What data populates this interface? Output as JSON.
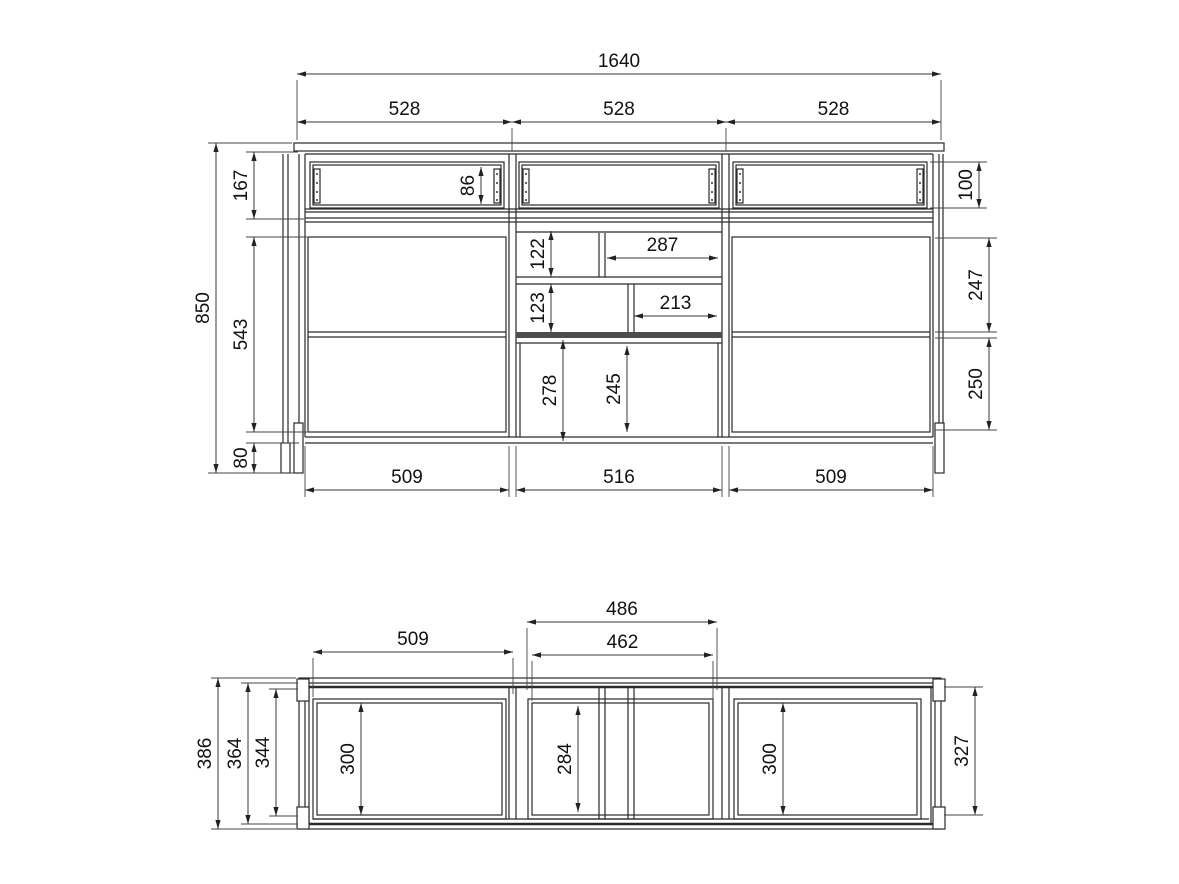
{
  "drawing": {
    "title": "furniture-sideboard-dimension-drawing",
    "units": "mm",
    "line_color": "#2a2a2a",
    "dim_color": "#222222",
    "background": "#ffffff",
    "views": {
      "front": {
        "name": "front-elevation",
        "overall_width": "1640",
        "overall_height": "850",
        "dimensions": [
          {
            "value": "1640",
            "orient": "h",
            "from": 297,
            "to": 941,
            "at": 74
          },
          {
            "value": "528",
            "orient": "h",
            "from": 297,
            "to": 512,
            "at": 122
          },
          {
            "value": "528",
            "orient": "h",
            "from": 512,
            "to": 726,
            "at": 122
          },
          {
            "value": "528",
            "orient": "h",
            "from": 726,
            "to": 941,
            "at": 122
          },
          {
            "value": "850",
            "orient": "v",
            "from": 143,
            "to": 473,
            "at": 216
          },
          {
            "value": "167",
            "orient": "v",
            "from": 152,
            "to": 219,
            "at": 254
          },
          {
            "value": "543",
            "orient": "v",
            "from": 237,
            "to": 432,
            "at": 254
          },
          {
            "value": "80",
            "orient": "v",
            "from": 443,
            "to": 473,
            "at": 254
          },
          {
            "value": "86",
            "orient": "v",
            "from": 167,
            "to": 204,
            "at": 481
          },
          {
            "value": "100",
            "orient": "v",
            "from": 162,
            "to": 208,
            "at": 979
          },
          {
            "value": "247",
            "orient": "v",
            "from": 238,
            "to": 332,
            "at": 989
          },
          {
            "value": "250",
            "orient": "v",
            "from": 338,
            "to": 430,
            "at": 989
          },
          {
            "value": "122",
            "orient": "v",
            "from": 231,
            "to": 277,
            "at": 551
          },
          {
            "value": "287",
            "orient": "h",
            "from": 607,
            "to": 718,
            "at": 258
          },
          {
            "value": "123",
            "orient": "v",
            "from": 284,
            "to": 332,
            "at": 551
          },
          {
            "value": "213",
            "orient": "h",
            "from": 634,
            "to": 717,
            "at": 316
          },
          {
            "value": "278",
            "orient": "v",
            "from": 340,
            "to": 441,
            "at": 563
          },
          {
            "value": "245",
            "orient": "v",
            "from": 346,
            "to": 432,
            "at": 627
          },
          {
            "value": "509",
            "orient": "h",
            "from": 305,
            "to": 509,
            "at": 490
          },
          {
            "value": "516",
            "orient": "h",
            "from": 516,
            "to": 722,
            "at": 490
          },
          {
            "value": "509",
            "orient": "h",
            "from": 729,
            "to": 933,
            "at": 490
          }
        ],
        "extension_lines": [
          [
            297,
            80,
            297,
            140
          ],
          [
            941,
            80,
            941,
            140
          ],
          [
            512,
            128,
            512,
            151
          ],
          [
            726,
            128,
            726,
            151
          ],
          [
            208,
            143,
            292,
            143
          ],
          [
            208,
            473,
            294,
            473
          ],
          [
            246,
            152,
            298,
            152
          ],
          [
            246,
            219,
            304,
            219
          ],
          [
            246,
            237,
            307,
            237
          ],
          [
            246,
            432,
            307,
            432
          ],
          [
            246,
            443,
            299,
            443
          ],
          [
            930,
            162,
            987,
            162
          ],
          [
            930,
            208,
            987,
            208
          ],
          [
            935,
            238,
            997,
            238
          ],
          [
            935,
            332,
            997,
            332
          ],
          [
            935,
            338,
            997,
            338
          ],
          [
            935,
            430,
            997,
            430
          ],
          [
            305,
            446,
            305,
            497
          ],
          [
            509,
            446,
            509,
            497
          ],
          [
            516,
            446,
            516,
            497
          ],
          [
            722,
            446,
            722,
            497
          ],
          [
            729,
            446,
            729,
            497
          ],
          [
            933,
            446,
            933,
            497
          ]
        ]
      },
      "plan": {
        "name": "plan-view",
        "overall_depth": "386",
        "dimensions": [
          {
            "value": "509",
            "orient": "h",
            "from": 313,
            "to": 513,
            "at": 652
          },
          {
            "value": "486",
            "orient": "h",
            "from": 527,
            "to": 717,
            "at": 622
          },
          {
            "value": "462",
            "orient": "h",
            "from": 532,
            "to": 713,
            "at": 655
          },
          {
            "value": "386",
            "orient": "v",
            "from": 678,
            "to": 829,
            "at": 218
          },
          {
            "value": "364",
            "orient": "v",
            "from": 683,
            "to": 824,
            "at": 248
          },
          {
            "value": "344",
            "orient": "v",
            "from": 689,
            "to": 816,
            "at": 276
          },
          {
            "value": "300",
            "orient": "v",
            "from": 703,
            "to": 815,
            "at": 361
          },
          {
            "value": "284",
            "orient": "v",
            "from": 706,
            "to": 812,
            "at": 578
          },
          {
            "value": "300",
            "orient": "v",
            "from": 703,
            "to": 815,
            "at": 783
          },
          {
            "value": "327",
            "orient": "v",
            "from": 687,
            "to": 815,
            "at": 975
          }
        ],
        "extension_lines": [
          [
            313,
            658,
            313,
            697
          ],
          [
            513,
            658,
            513,
            694
          ],
          [
            527,
            628,
            527,
            690
          ],
          [
            717,
            628,
            717,
            690
          ],
          [
            532,
            661,
            532,
            701
          ],
          [
            713,
            661,
            713,
            701
          ],
          [
            211,
            678,
            296,
            678
          ],
          [
            211,
            829,
            296,
            829
          ],
          [
            241,
            683,
            298,
            683
          ],
          [
            241,
            824,
            298,
            824
          ],
          [
            269,
            689,
            298,
            689
          ],
          [
            269,
            816,
            298,
            816
          ],
          [
            944,
            687,
            983,
            687
          ],
          [
            944,
            815,
            983,
            815
          ]
        ]
      }
    }
  }
}
